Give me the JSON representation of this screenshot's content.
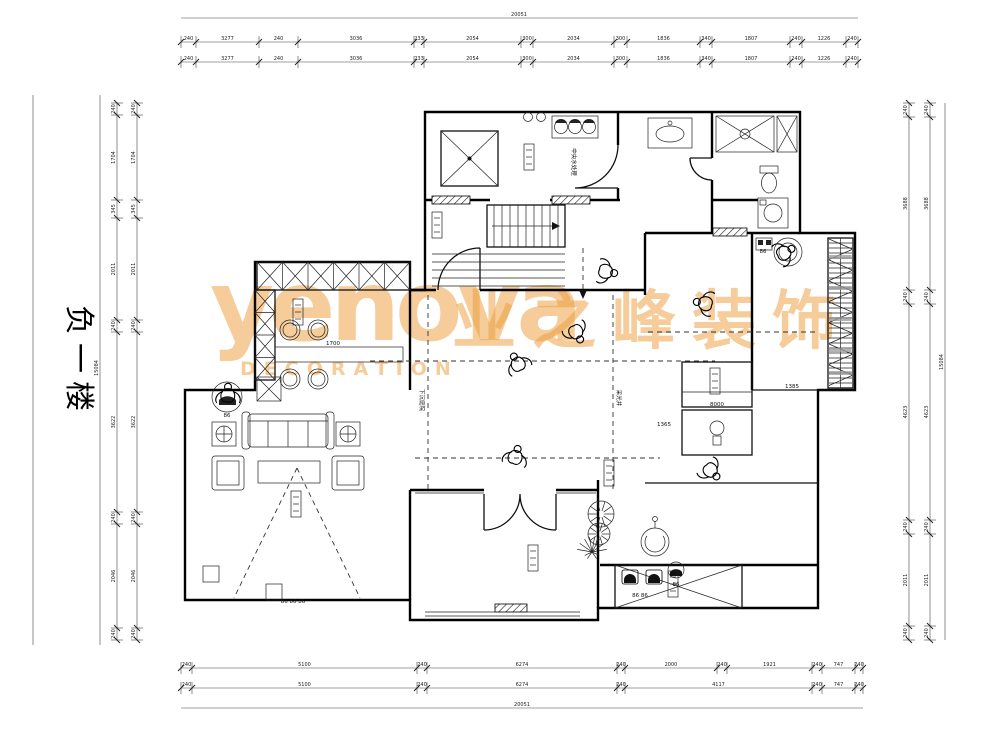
{
  "title": {
    "text": "负一楼"
  },
  "watermark": {
    "brand": "yenova",
    "cn": "业之峰装饰",
    "sub": "DECORATION",
    "color": "#eb9e3e"
  },
  "labels": {
    "equipment": "中央水处理",
    "void_left": "下沉庭院",
    "void_right": "采光井"
  },
  "dims": {
    "h": [
      {
        "y": 42,
        "ticks": [
          181,
          196,
          259,
          298,
          414,
          424,
          521,
          533,
          614,
          627,
          700,
          712,
          790,
          802,
          846,
          858
        ],
        "values": [
          "240",
          "3277",
          "240",
          "3036",
          "233",
          "2054",
          "300",
          "2034",
          "300",
          "1836",
          "340",
          "1807",
          "240",
          "1226",
          "240"
        ]
      },
      {
        "y": 62,
        "ticks": [
          181,
          196,
          259,
          298,
          414,
          424,
          521,
          533,
          614,
          627,
          700,
          712,
          790,
          802,
          846,
          858
        ],
        "values": [
          "240",
          "3277",
          "240",
          "3036",
          "233",
          "2054",
          "300",
          "2034",
          "300",
          "1836",
          "340",
          "1807",
          "240",
          "1226",
          "240"
        ]
      },
      {
        "y": 668,
        "ticks": [
          181,
          192,
          417,
          427,
          617,
          625,
          717,
          727,
          812,
          822,
          855,
          863
        ],
        "values": [
          "240",
          "5100",
          "240",
          "6274",
          "240",
          "2000",
          "240",
          "1921",
          "240",
          "747",
          "240"
        ]
      },
      {
        "y": 688,
        "ticks": [
          181,
          192,
          417,
          427,
          617,
          625,
          812,
          822,
          855,
          863
        ],
        "values": [
          "240",
          "5100",
          "240",
          "6274",
          "240",
          "4117",
          "240",
          "747",
          "240"
        ]
      }
    ],
    "v": [
      {
        "x": 117,
        "ticks": [
          103,
          115,
          200,
          218,
          320,
          332,
          512,
          524,
          628,
          640
        ],
        "values": [
          "240",
          "1704",
          "345",
          "2011",
          "240",
          "3622",
          "240",
          "2046",
          "240"
        ]
      },
      {
        "x": 137,
        "ticks": [
          103,
          115,
          200,
          218,
          320,
          332,
          512,
          524,
          628,
          640
        ],
        "values": [
          "240",
          "1704",
          "345",
          "2011",
          "240",
          "3622",
          "240",
          "2046",
          "240"
        ]
      },
      {
        "x": 909,
        "ticks": [
          103,
          117,
          290,
          304,
          520,
          534,
          626,
          640
        ],
        "values": [
          "240",
          "3688",
          "240",
          "4623",
          "240",
          "2011",
          "240"
        ]
      },
      {
        "x": 930,
        "ticks": [
          103,
          117,
          290,
          304,
          520,
          534,
          626,
          640
        ],
        "values": [
          "240",
          "3688",
          "240",
          "4623",
          "240",
          "2011",
          "240"
        ]
      }
    ],
    "overall_h": [
      {
        "y": 18,
        "x1": 181,
        "x2": 858,
        "label": "20051",
        "tx": 519
      },
      {
        "y": 708,
        "x1": 181,
        "x2": 863,
        "label": "20051",
        "tx": 522
      }
    ],
    "overall_v": [
      {
        "x": 100,
        "y1": 95,
        "y2": 645,
        "label": "15084",
        "ty": 368
      },
      {
        "x": 945,
        "y1": 103,
        "y2": 640,
        "label": "15084",
        "ty": 362
      }
    ]
  },
  "annotations": {
    "code_tags": [
      {
        "x": 227,
        "y": 417,
        "t": "86"
      },
      {
        "x": 640,
        "y": 597,
        "t": "86 86"
      },
      {
        "x": 676,
        "y": 586,
        "t": "86"
      },
      {
        "x": 293,
        "y": 603,
        "t": "86 86 86"
      },
      {
        "x": 763,
        "y": 253,
        "t": "86"
      }
    ],
    "tiny_dims": [
      {
        "x": 333,
        "y": 345,
        "t": "1700"
      },
      {
        "x": 717,
        "y": 406,
        "t": "8000"
      },
      {
        "x": 664,
        "y": 426,
        "t": "1365"
      },
      {
        "x": 792,
        "y": 388,
        "t": "1385"
      }
    ]
  }
}
